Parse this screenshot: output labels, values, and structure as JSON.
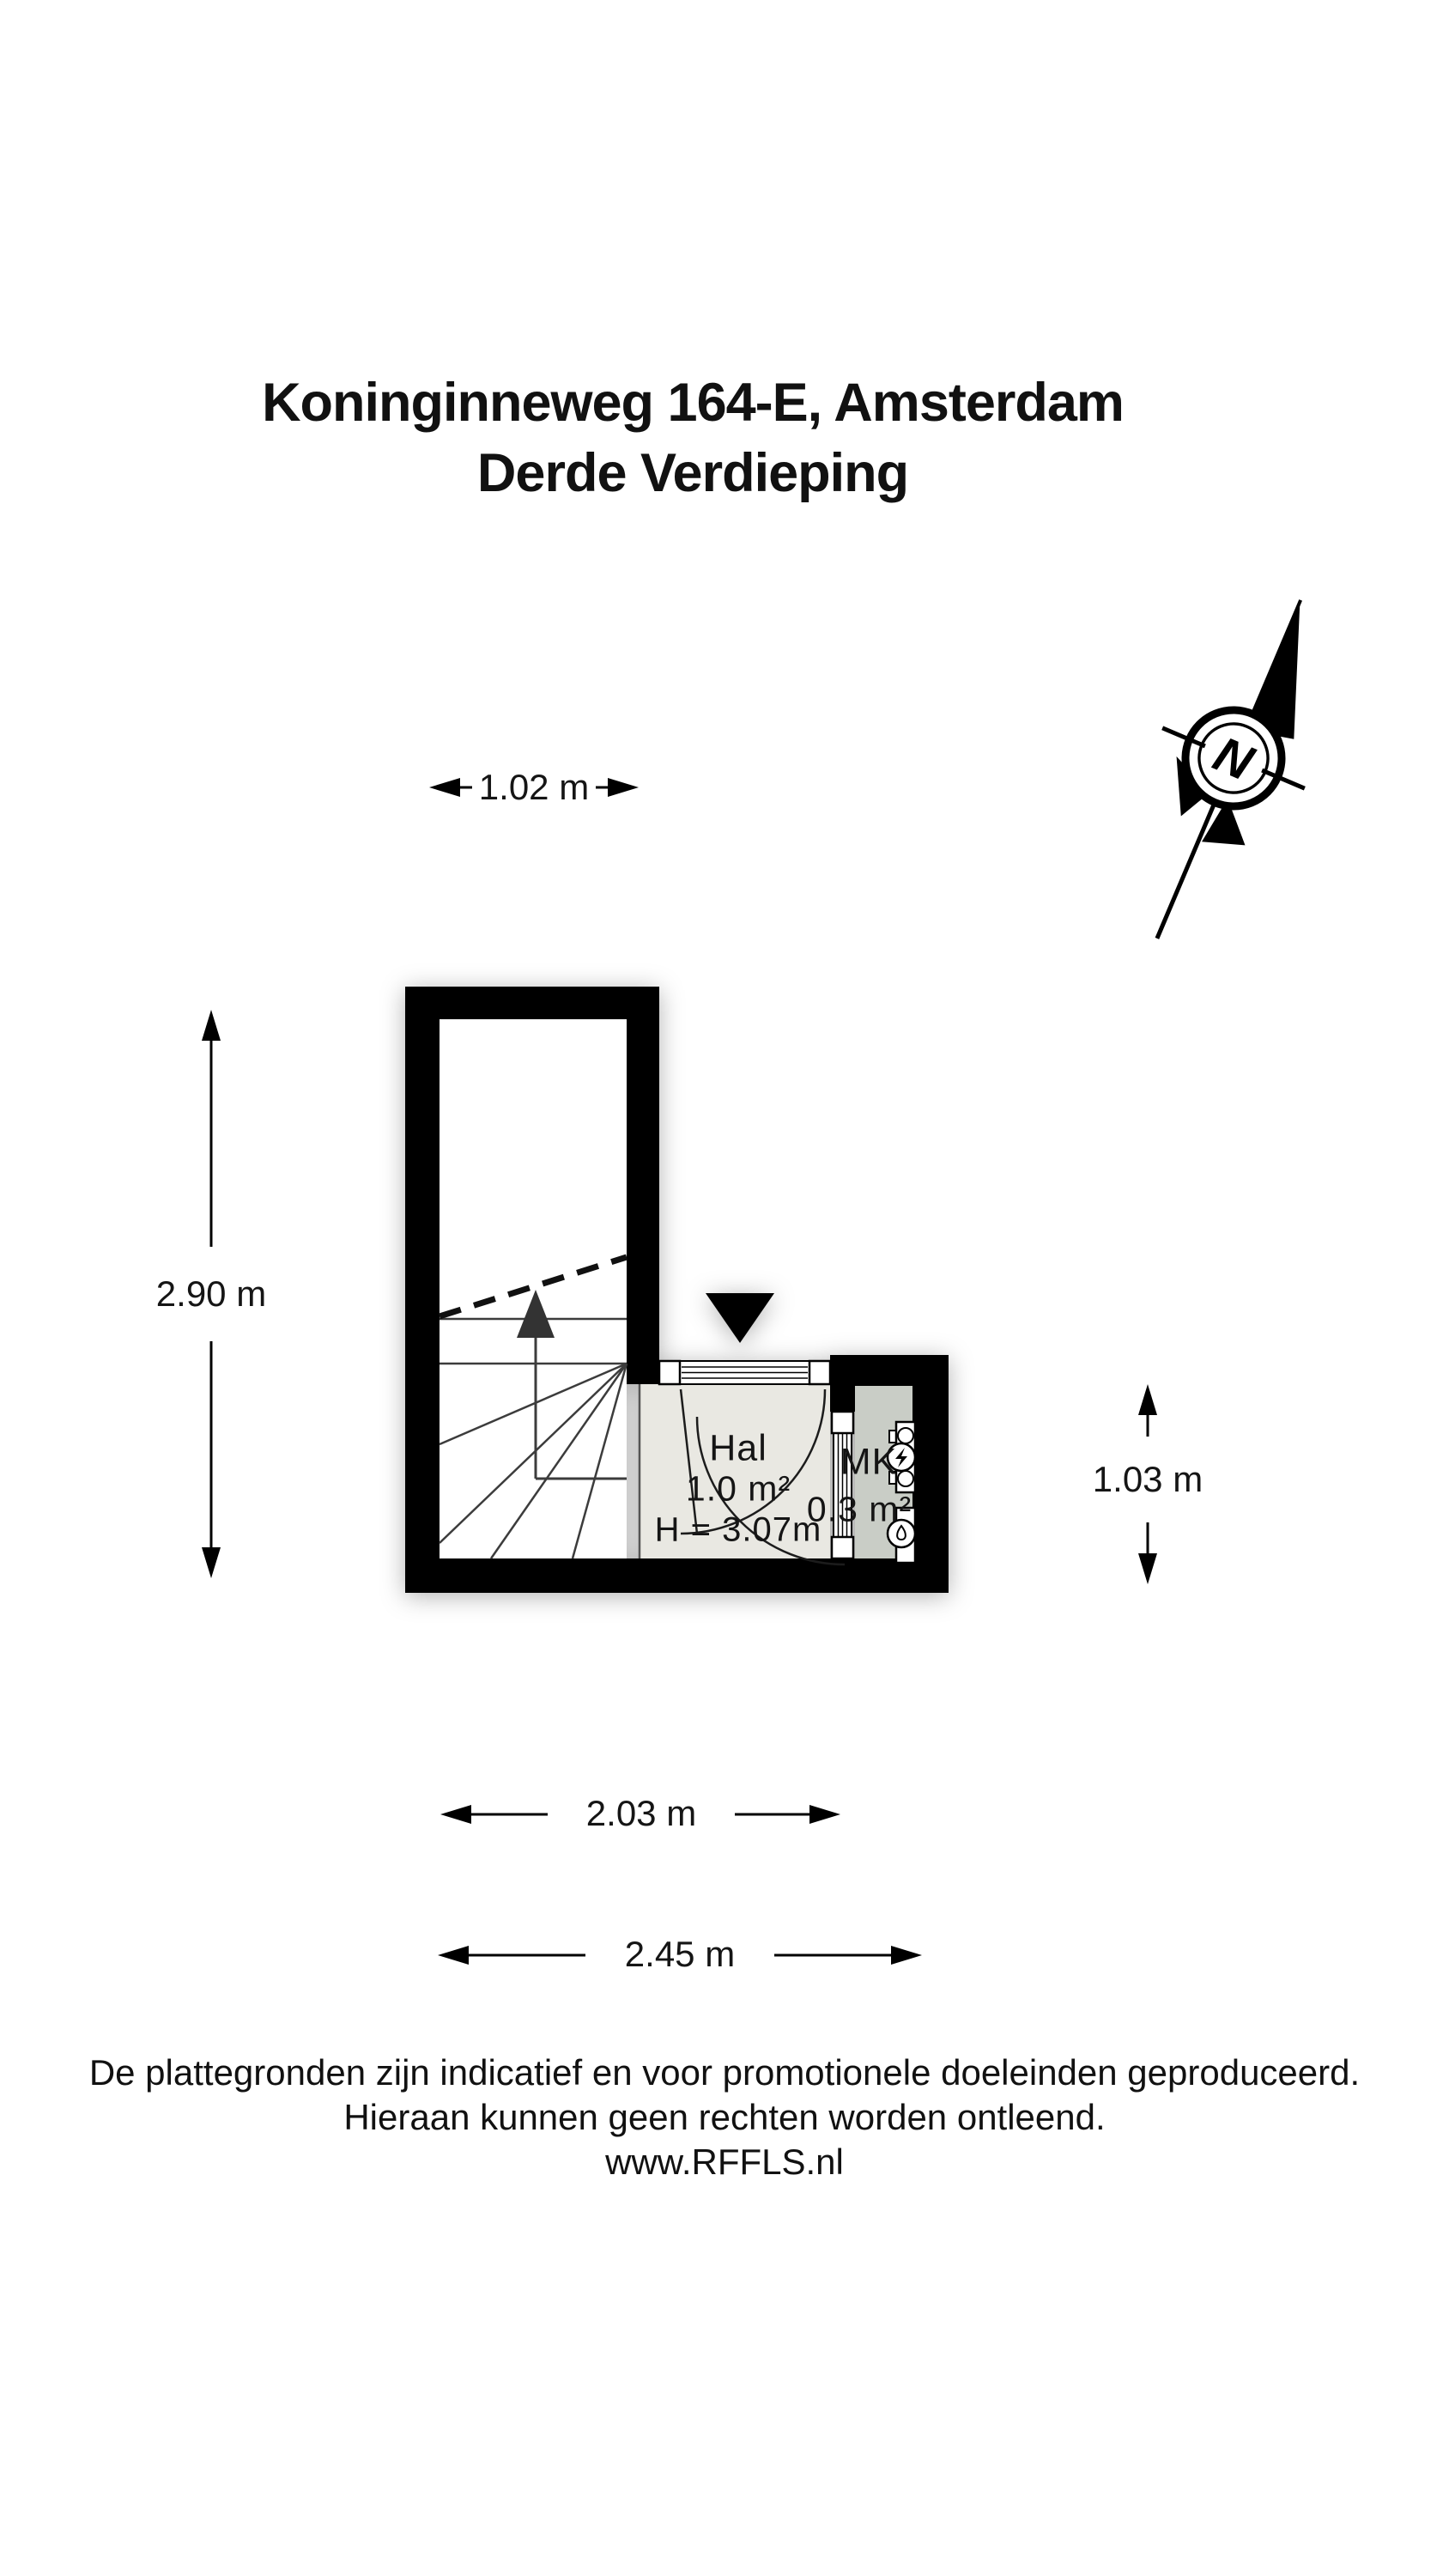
{
  "title": {
    "line1": "Koninginneweg 164-E, Amsterdam",
    "line2": "Derde Verdieping"
  },
  "compass": {
    "north_label": "N"
  },
  "dimensions": {
    "top_width": "1.02 m",
    "left_height": "2.90 m",
    "right_height": "1.03 m",
    "bottom_width_inner": "2.03 m",
    "bottom_width_outer": "2.45 m"
  },
  "rooms": {
    "hal": {
      "name": "Hal",
      "area": "1.0 m²",
      "ceiling_height": "H = 3.07m"
    },
    "mk": {
      "name": "MK",
      "area": "0.3 m²"
    }
  },
  "footer": {
    "line1": "De plattegronden zijn indicatief en voor promotionele doeleinden geproduceerd.",
    "line2": "Hieraan kunnen geen rechten worden ontleend.",
    "line3": "www.RFFLS.nl"
  },
  "colors": {
    "wall": "#000000",
    "hal_floor": "#e9e8e2",
    "mk_floor": "#c9cdc6",
    "stair_line": "#3c3c3c",
    "text": "#151515"
  }
}
